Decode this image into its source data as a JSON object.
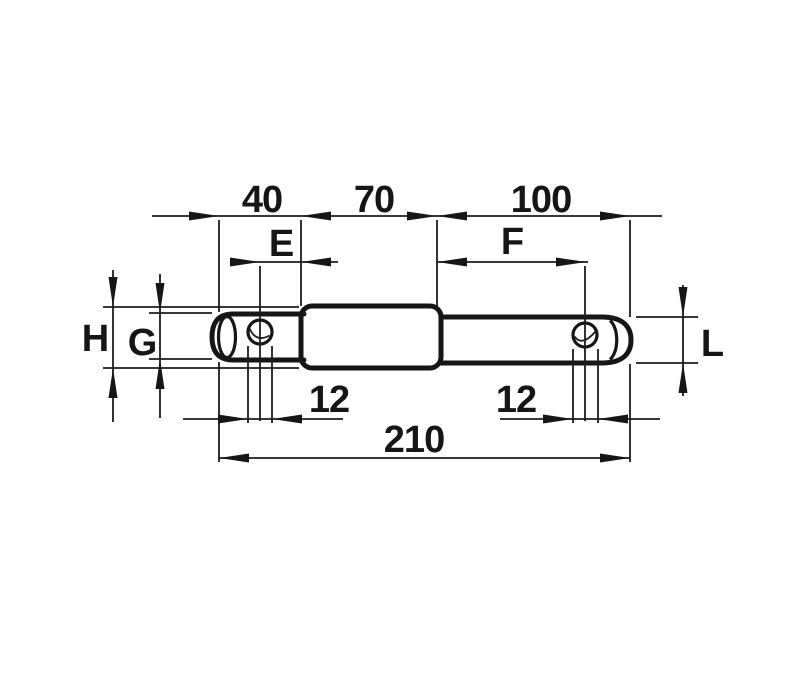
{
  "drawing": {
    "background_color": "#ffffff",
    "line_color": "#161616",
    "part": "stepped-pin-side-view",
    "labels": {
      "top_left_length": "40",
      "top_middle_length": "70",
      "top_right_length": "100",
      "dim_e": "E",
      "dim_f": "F",
      "dia_h": "H",
      "dia_g": "G",
      "dia_l": "L",
      "hole_left_dia": "12",
      "hole_right_dia": "12",
      "overall_length": "210"
    }
  }
}
